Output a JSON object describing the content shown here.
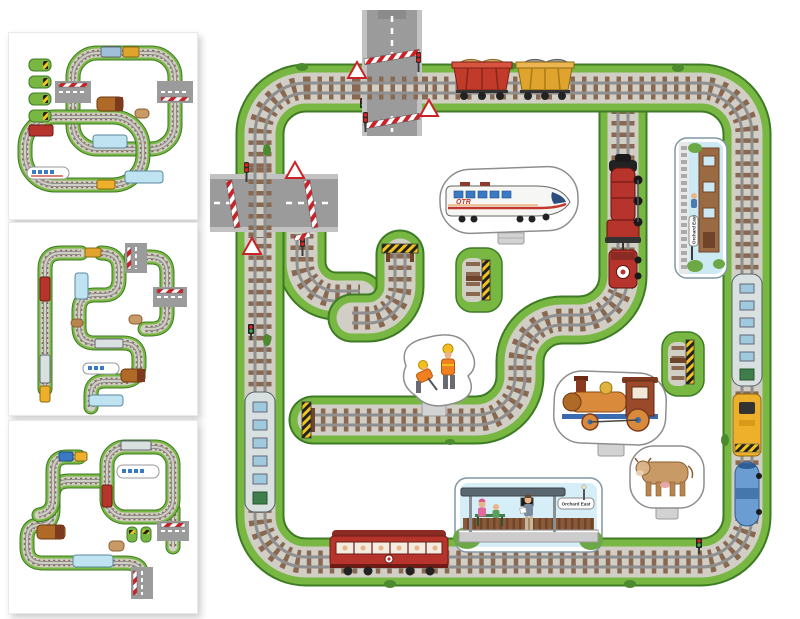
{
  "scene": {
    "kind": "railway-jigsaw-puzzle-product-image",
    "signs": {
      "platform_sign": "Orchard East",
      "side_station_sign": "Orchard East"
    },
    "train_logo": "OTR",
    "colors": {
      "grass": "#79b743",
      "grass_edge": "#3e7b25",
      "ballast": "#d0cec5",
      "sleeper": "#8a6850",
      "rail": "#8f8f8f",
      "road": "#9b9b9b",
      "barrier_red": "#cc2127",
      "buffer_yellow": "#f2c41d",
      "loco_red": "#b7342c",
      "hopper_red": "#c23b2a",
      "hopper_yellow": "#e0a32e",
      "coach_silver": "#d9e0e0",
      "shunter_yellow": "#eeb02a",
      "tanker_blue": "#6b9cd2",
      "toy_engine_orange": "#d98a3a",
      "cow_tan": "#c89b66",
      "vest_orange": "#f08020"
    },
    "main_board": {
      "pieces": [
        "square-track-loop",
        "level-crossing-top",
        "level-crossing-left",
        "inner-branch-with-steam-locomotive",
        "buffer-spur",
        "station-platform",
        "trackside-station",
        "freight-hoppers",
        "red-carriage",
        "silver-coaches",
        "yellow-shunter",
        "blue-tanker-wagon",
        "high-speed-train-standup",
        "toy-engine-standup",
        "workmen-standup",
        "cow-standup",
        "loose-buffer-pieces"
      ]
    },
    "thumbnails": [
      {
        "name": "alternative-layout-1"
      },
      {
        "name": "alternative-layout-2"
      },
      {
        "name": "alternative-layout-3"
      }
    ]
  }
}
